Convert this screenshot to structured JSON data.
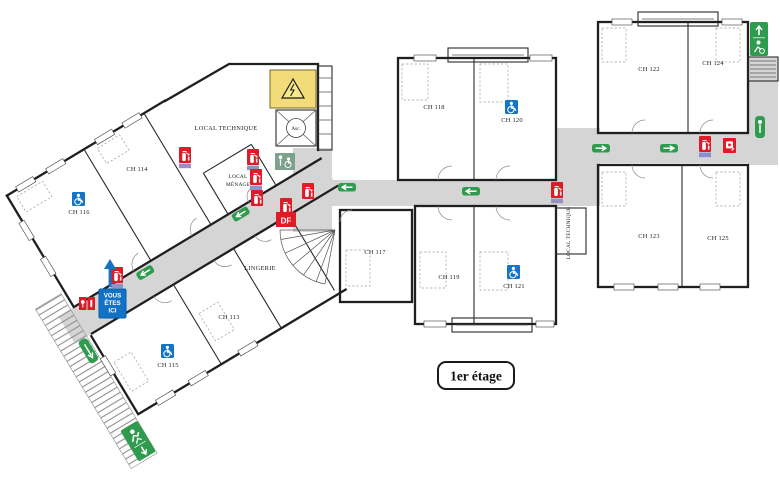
{
  "floor_badge": "1er étage",
  "you_are_here": {
    "lines": [
      "VOUS",
      "ÊTES",
      "ICI"
    ]
  },
  "rooms": {
    "ch113": "CH 113",
    "ch114": "CH 114",
    "ch115": "CH 115",
    "ch116": "CH 116",
    "ch117": "CH 117",
    "ch118": "CH 118",
    "ch119": "CH 119",
    "ch120": "CH 120",
    "ch121": "CH 121",
    "ch122": "CH 122",
    "ch123": "CH 123",
    "ch124": "CH 124",
    "ch125": "CH 125",
    "local_technique": "LOCAL TECHNIQUE",
    "local_menage_line1": "LOCAL",
    "local_menage_line2": "MÉNAGE",
    "lingerie": "LINGERIE",
    "local_technique_shaft": "LOCAL TECHNIQUE",
    "elevator": "Asc."
  },
  "labels": {
    "fire_door": "DF"
  },
  "icons": {
    "fire_extinguisher": "extincteur (carré rouge)",
    "manual_call_point": "déclencheur manuel (carré rouge, main)",
    "fire_door": "porte coupe-feu DF",
    "evacuation_arrow": "sens d'évacuation (flèche verte)",
    "emergency_exit": "sortie de secours (homme qui court + flèche)",
    "refuge_area": "espace d'attente sécurisé (vert-gris, personne + fauteuil)",
    "wheelchair_accessible": "chambre accessible PMR (carré bleu ♿)",
    "elevator": "ascenseur (croix + cercle Asc.)",
    "hazard_room": "local à risque (jaune, triangle danger électrique)",
    "you_are_here_arrow": "flèche bleue vers le haut"
  },
  "colors": {
    "corridor_gray": "#d5d5d5",
    "safety_red": "#e01b28",
    "exit_green": "#2f9b4e",
    "refuge_sage": "#7ca28b",
    "accessible_blue": "#1574c5",
    "base_purple": "#988fc4",
    "base_periwinkle": "#8a8fd0",
    "hazard_yellow": "#f2dc7a",
    "wall_black": "#1f1f1f"
  }
}
